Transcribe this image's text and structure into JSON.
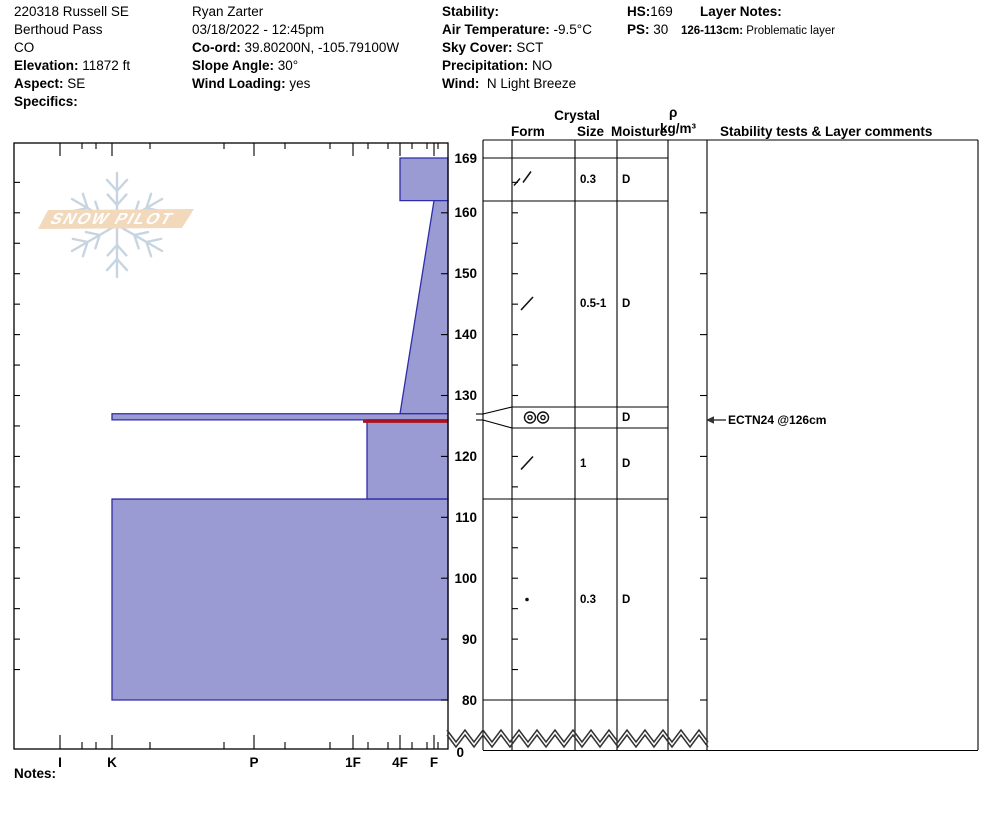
{
  "colors": {
    "layer_fill": "#9b9bd4",
    "layer_stroke": "#2d2da8",
    "problem_red": "#aa1122",
    "logo_banner": "#f3d9bc",
    "logo_flake": "#c7d5e1",
    "logo_text_color": "#ffffff"
  },
  "header": {
    "col1": {
      "line1": "220318 Russell SE",
      "line2": "Berthoud Pass",
      "line3": "CO",
      "elevation_label": "Elevation:",
      "elevation": "11872 ft",
      "aspect_label": "Aspect:",
      "aspect": "SE",
      "specifics_label": "Specifics:"
    },
    "col2": {
      "observer": "Ryan Zarter",
      "datetime": "03/18/2022 - 12:45pm",
      "coord_label": "Co-ord:",
      "coord": "39.80200N, -105.79100W",
      "slope_label": "Slope Angle:",
      "slope": "30°",
      "wind_loading_label": "Wind Loading:",
      "wind_loading": "yes"
    },
    "col3": {
      "stability_label": "Stability:",
      "stability": "",
      "air_temp_label": "Air Temperature:",
      "air_temp": "-9.5°C",
      "sky_label": "Sky Cover:",
      "sky": "SCT",
      "precip_label": "Precipitation:",
      "precip": "NO",
      "wind_label": "Wind:",
      "wind": "N Light Breeze"
    },
    "col4": {
      "hs_label": "HS:",
      "hs": "169",
      "ps_label": "PS:",
      "ps": "30"
    },
    "col5": {
      "layer_notes_label": "Layer Notes:",
      "note_range": "126-113cm:",
      "note_text": "Problematic layer"
    }
  },
  "table": {
    "headers": {
      "crystal": "Crystal",
      "form": "Form",
      "size": "Size",
      "moisture": "Moisture",
      "rho": "ρ",
      "rho_units": "kg/m³",
      "stability": "Stability tests & Layer comments"
    }
  },
  "chart_data": {
    "type": "snow-profile-bar",
    "hs_cm": 169,
    "ps": 30,
    "depth_ticks_cm": [
      169,
      160,
      150,
      140,
      130,
      120,
      110,
      100,
      90,
      80
    ],
    "depth_break_label": "0",
    "hand_hardness_scale": [
      "I",
      "K",
      "P",
      "1F",
      "4F",
      "F"
    ],
    "layers": [
      {
        "top_cm": 169,
        "bottom_cm": 162,
        "hardness": "4F",
        "form": "decomposing-fragments-pair",
        "size_mm": "0.3",
        "moisture": "D"
      },
      {
        "top_cm": 162,
        "bottom_cm": 127,
        "hardness_top": "F",
        "hardness_bottom": "4F",
        "form": "decomposing-fragments",
        "size_mm": "0.5-1",
        "moisture": "D"
      },
      {
        "top_cm": 127,
        "bottom_cm": 126,
        "hardness": "K",
        "form": "clustered-rounds",
        "size_mm": "",
        "moisture": "D",
        "thin_layer_flag": true
      },
      {
        "top_cm": 126,
        "bottom_cm": 113,
        "hardness": "1F+",
        "form": "decomposing-fragments",
        "size_mm": "1",
        "moisture": "D",
        "problematic_top": true
      },
      {
        "top_cm": 113,
        "bottom_cm": 80,
        "hardness": "K",
        "form": "rounded-grains",
        "size_mm": "0.3",
        "moisture": "D"
      }
    ],
    "stability_tests": [
      {
        "label": "ECTN24 @126cm",
        "depth_cm": 126
      }
    ]
  },
  "logo": {
    "text": "SNOW PILOT"
  },
  "footer": {
    "notes_label": "Notes:"
  }
}
